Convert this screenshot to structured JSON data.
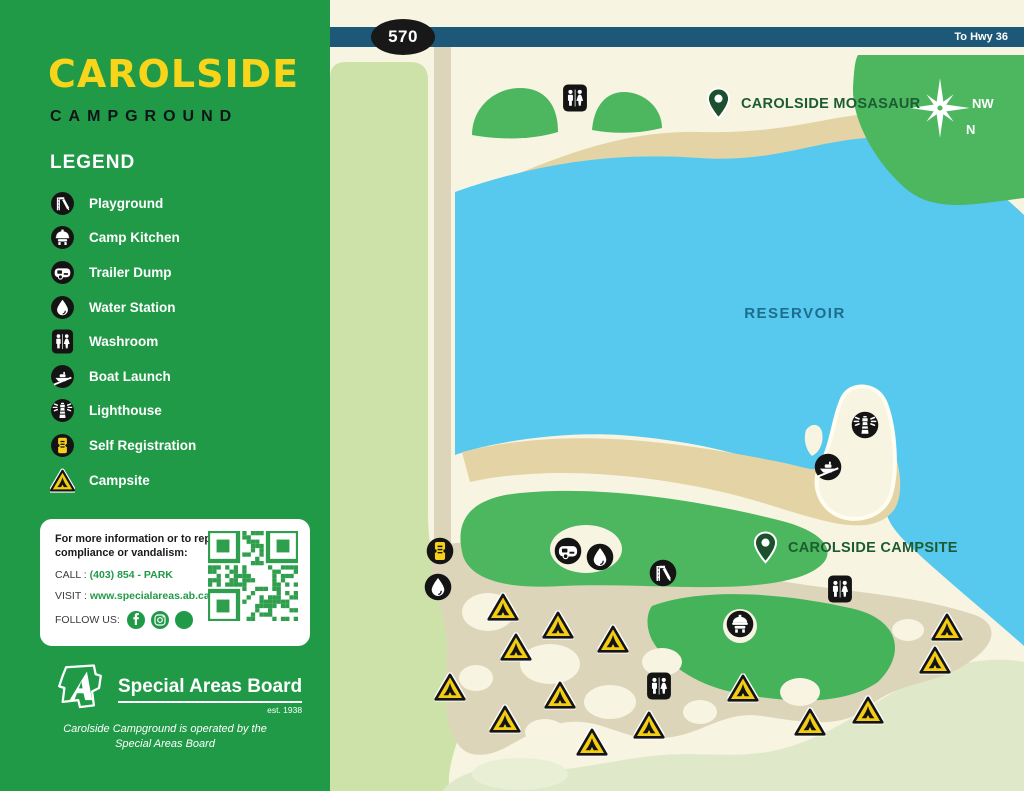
{
  "sidebar": {
    "logo_title": "CAROLSIDE",
    "logo_subtitle": "CAMPGROUND",
    "legend_title": "LEGEND",
    "legend_items": [
      {
        "icon": "playground",
        "label": "Playground"
      },
      {
        "icon": "camp-kitchen",
        "label": "Camp Kitchen"
      },
      {
        "icon": "trailer-dump",
        "label": "Trailer Dump"
      },
      {
        "icon": "water",
        "label": "Water Station"
      },
      {
        "icon": "washroom",
        "label": "Washroom"
      },
      {
        "icon": "boat-launch",
        "label": "Boat Launch"
      },
      {
        "icon": "lighthouse",
        "label": "Lighthouse"
      },
      {
        "icon": "self-registration",
        "label": "Self Registration"
      },
      {
        "icon": "campsite",
        "label": "Campsite"
      }
    ]
  },
  "info": {
    "heading": "For more information or to report non-compliance or vandalism:",
    "call_label": "CALL :",
    "call_value": "(403) 854 - PARK",
    "visit_label": "VISIT :",
    "visit_value": "www.specialareas.ab.ca",
    "follow_label": "FOLLOW US:",
    "socials": [
      "facebook",
      "instagram",
      "other"
    ]
  },
  "board": {
    "name": "Special Areas Board",
    "est": "est. 1938",
    "note": "Carolside Campground is operated by the Special Areas Board"
  },
  "map": {
    "road_number": "570",
    "road_destination": "To Hwy 36",
    "labels": {
      "reservoir": "RESERVOIR"
    },
    "compass": {
      "nw": "NW",
      "n": "N"
    },
    "pins": [
      {
        "label": "CAROLSIDE MOSASAUR",
        "x": 388,
        "y": 104
      },
      {
        "label": "CAROLSIDE CAMPSITE",
        "x": 435,
        "y": 548
      }
    ],
    "icons": [
      {
        "type": "washroom",
        "x": 245,
        "y": 98
      },
      {
        "type": "washroom",
        "x": 510,
        "y": 589
      },
      {
        "type": "washroom",
        "x": 329,
        "y": 686
      },
      {
        "type": "self-registration",
        "x": 110,
        "y": 551
      },
      {
        "type": "water",
        "x": 108,
        "y": 587
      },
      {
        "type": "trailer-dump",
        "x": 238,
        "y": 551
      },
      {
        "type": "water",
        "x": 270,
        "y": 557
      },
      {
        "type": "playground",
        "x": 333,
        "y": 573
      },
      {
        "type": "camp-kitchen",
        "x": 410,
        "y": 624
      },
      {
        "type": "lighthouse",
        "x": 535,
        "y": 425
      },
      {
        "type": "boat-launch",
        "x": 498,
        "y": 467
      }
    ],
    "campsites": [
      {
        "x": 173,
        "y": 607
      },
      {
        "x": 228,
        "y": 625
      },
      {
        "x": 283,
        "y": 639
      },
      {
        "x": 186,
        "y": 647
      },
      {
        "x": 120,
        "y": 687
      },
      {
        "x": 230,
        "y": 695
      },
      {
        "x": 175,
        "y": 719
      },
      {
        "x": 262,
        "y": 742
      },
      {
        "x": 319,
        "y": 725
      },
      {
        "x": 413,
        "y": 688
      },
      {
        "x": 617,
        "y": 627
      },
      {
        "x": 605,
        "y": 660
      },
      {
        "x": 538,
        "y": 710
      },
      {
        "x": 480,
        "y": 722
      }
    ],
    "colors": {
      "sidebar_green": "#219a48",
      "logo_yellow": "#f8d41b",
      "water_blue": "#57c8ee",
      "map_green": "#4cb75e",
      "road_blue": "#1d5878",
      "sand": "#e4d3a4",
      "path_tan": "#dcd5ba",
      "pale_green": "#cde2a9",
      "cream": "#f7f4e1",
      "pin_green": "#1c4f2d",
      "campsite_yellow": "#f2cd13"
    }
  }
}
